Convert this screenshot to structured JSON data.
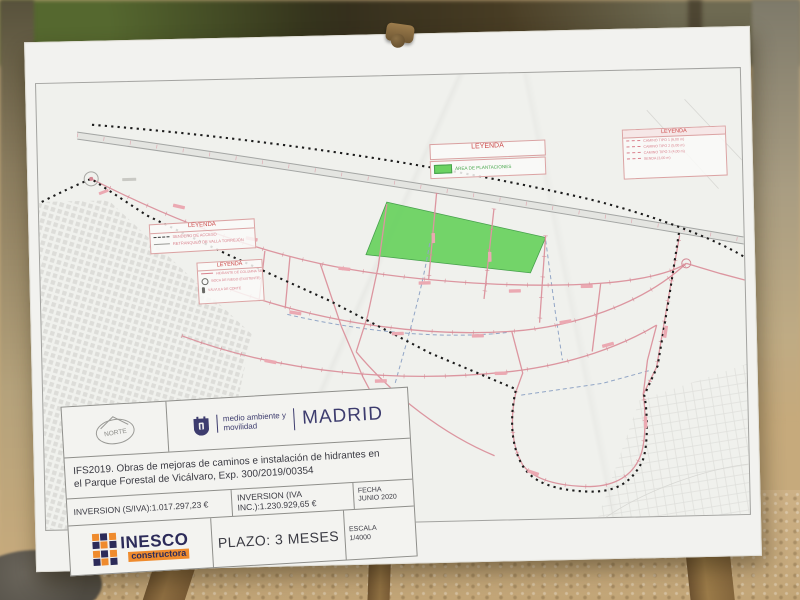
{
  "poster": {
    "map_legends": {
      "accesos": {
        "title": "LEYENDA",
        "items": [
          {
            "label": "SENDERO DE ACCESO"
          },
          {
            "label": "RETRANQUEO DE VALLA TORREJÓN"
          }
        ]
      },
      "hidrantes": {
        "title": "LEYENDA",
        "items": [
          {
            "label": "HIDRANTE DE COLUMNA SECA CON ARQUETA"
          },
          {
            "label": "BOCA DE RIEGO (EXISTENTE)"
          },
          {
            "label": "VÁLVULA DE CORTE"
          }
        ]
      },
      "plantaciones": {
        "title": "LEYENDA",
        "item": "ÁREA DE PLANTACIONES"
      },
      "caminos": {
        "title": "LEYENDA",
        "items": [
          {
            "label": "CAMINO TIPO 1 (6,00 m)"
          },
          {
            "label": "CAMINO TIPO 2 (5,00 m)"
          },
          {
            "label": "CAMINO TIPO 3 (4,00 m)"
          },
          {
            "label": "SENDA (3,00 m)"
          }
        ]
      }
    },
    "title_block": {
      "north_label": "NORTE",
      "department_line1": "medio ambiente y",
      "department_line2": "movilidad",
      "city": "MADRID",
      "project_title_line1": "IFS2019. Obras de mejoras de caminos e instalación de hidrantes en",
      "project_title_line2": "el Parque Forestal de Vicálvaro, Exp. 300/2019/00354",
      "investment_ex_vat": "INVERSION (S/IVA):1.017.297,23 €",
      "investment_inc_vat": "INVERSION (IVA INC.):1.230.929,65 €",
      "fecha_label": "FECHA",
      "fecha_value": "JUNIO 2020",
      "escala_label": "ESCALA",
      "escala_value": "1/4000",
      "plazo": "PLAZO: 3 MESES",
      "contractor_name": "INESCO",
      "contractor_sub": "constructora"
    },
    "colors": {
      "plantation_green": "#6cd262",
      "road_pink": "#dc96a0",
      "legend_red": "#cc4a4a",
      "madrid_navy": "#3d3c6e",
      "inesco_navy": "#2c2b59",
      "inesco_orange": "#ef8b2d",
      "boundary_black": "#1c1c1c"
    }
  }
}
